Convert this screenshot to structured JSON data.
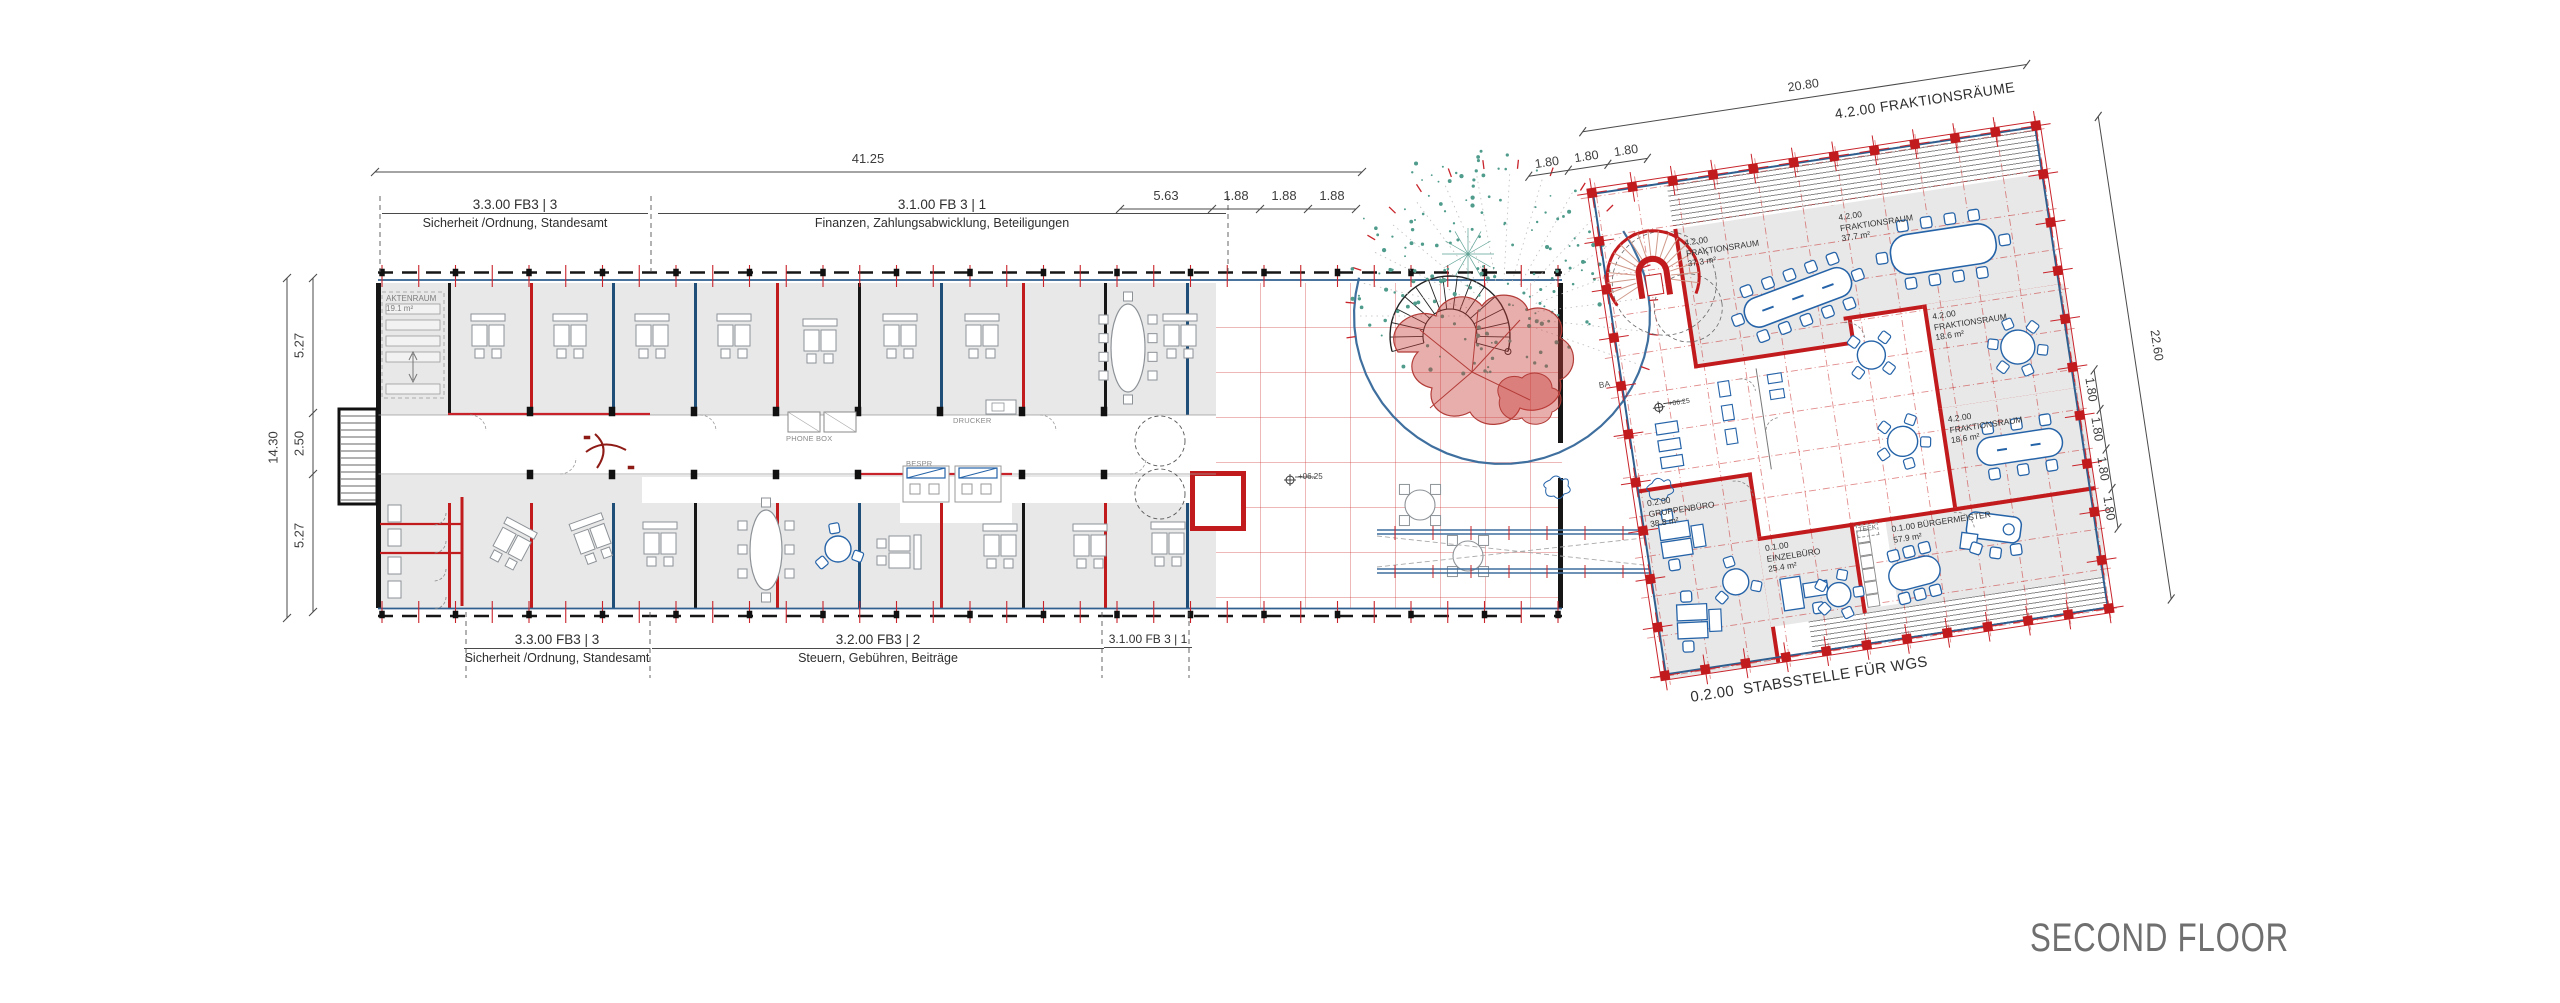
{
  "title": "SECOND FLOOR",
  "colors": {
    "wall_red": "#c21b1e",
    "facade_blue": "#2f5f8f",
    "furniture_blue": "#2563a8",
    "room_fill": "#e8e8e8",
    "foliage_teal": "#57a393",
    "canopy_red": "#b03a37",
    "dim_text": "#3a3a3a",
    "title_gray": "#6e6e6e"
  },
  "left_building": {
    "dims": {
      "total_width": "41.25",
      "top_right_segs": [
        "5.63",
        "1.88",
        "1.88",
        "1.88"
      ],
      "total_height": "14.30",
      "left_segs": [
        "5.27",
        "2.50",
        "5.27"
      ]
    },
    "zones_top": [
      {
        "code": "3.3.00 FB3 | 3",
        "name": "Sicherheit /Ordnung, Standesamt"
      },
      {
        "code": "3.1.00 FB 3 | 1",
        "name": "Finanzen, Zahlungsabwicklung, Beteiligungen"
      }
    ],
    "zones_bottom": [
      {
        "code": "3.3.00 FB3 | 3",
        "name": "Sicherheit /Ordnung, Standesamt"
      },
      {
        "code": "3.2.00 FB3 | 2",
        "name": "Steuern, Gebühren, Beiträge"
      },
      {
        "code": "3.1.00 FB 3 | 1",
        "name": ""
      }
    ],
    "aktenraum": {
      "name": "AKTENRAUM",
      "area": "19.1 m²"
    },
    "phone_box": "PHONE BOX",
    "drucker": "DRUCKER",
    "bespr": "BESPR",
    "level_marker": "+06.25"
  },
  "right_building": {
    "label_top": {
      "code": "4.2.00",
      "name": "FRAKTIONSRÄUME"
    },
    "label_bottom": {
      "code": "0.2.00",
      "name": "STABSSTELLE FÜR WGS"
    },
    "grid_axis_label": "BA",
    "level_marker": "+06.25",
    "dims": {
      "top_total": "20.80",
      "top_segs": [
        "1.80",
        "1.80",
        "1.80"
      ],
      "right_total": "22.60",
      "right_segs": [
        "1.80",
        "1.80",
        "1.80",
        "1.80"
      ]
    },
    "fraktionsraeume": [
      {
        "code": "4.2.00",
        "name": "FRAKTIONSRAUM",
        "area": "37.3 m²"
      },
      {
        "code": "4.2.00",
        "name": "FRAKTIONSRAUM",
        "area": "37.7 m²"
      },
      {
        "code": "4.2.00",
        "name": "FRAKTIONSRAUM",
        "area": "18.6 m²"
      },
      {
        "code": "4.2.00",
        "name": "FRAKTIONSRAUM",
        "area": "18.6 m²"
      }
    ],
    "buergermeister": {
      "code": "0.1.00",
      "name": "BÜRGERMEISTER",
      "area": "57.9 m²"
    },
    "gruppenbuero": {
      "code": "0.2.00",
      "name": "GRUPPENBÜRO",
      "area": "38.8 m²"
    },
    "einzelbuero": {
      "code": "0.1.00",
      "name": "EINZELBÜRO",
      "area": "25.4 m²"
    },
    "teekueche": {
      "name": "TEEK"
    }
  }
}
